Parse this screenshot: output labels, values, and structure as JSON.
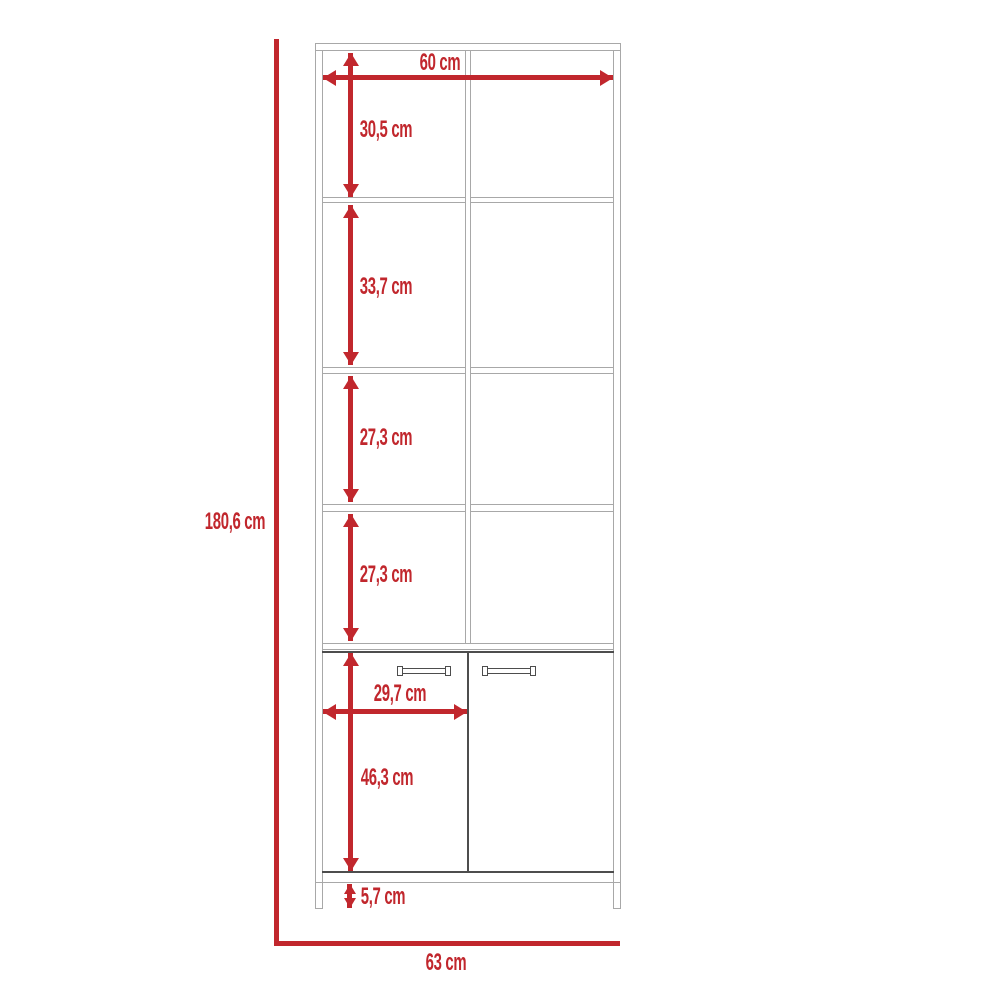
{
  "diagram": {
    "kind": "furniture dimension drawing",
    "unit": "cm"
  },
  "colors": {
    "dimension": "#c1272d",
    "furniture_line": "#a8a8a8",
    "door_line": "#4d4d4d",
    "background": "#ffffff"
  },
  "dimensions": {
    "overall_height": "180,6 cm",
    "overall_width": "63 cm",
    "top_inner_width": "60 cm",
    "compartment_1_height": "30,5 cm",
    "compartment_2_height": "33,7 cm",
    "compartment_3_height": "27,3 cm",
    "compartment_4_height": "27,3 cm",
    "door_width": "29,7 cm",
    "door_height": "46,3 cm",
    "base_height": "5,7 cm"
  }
}
